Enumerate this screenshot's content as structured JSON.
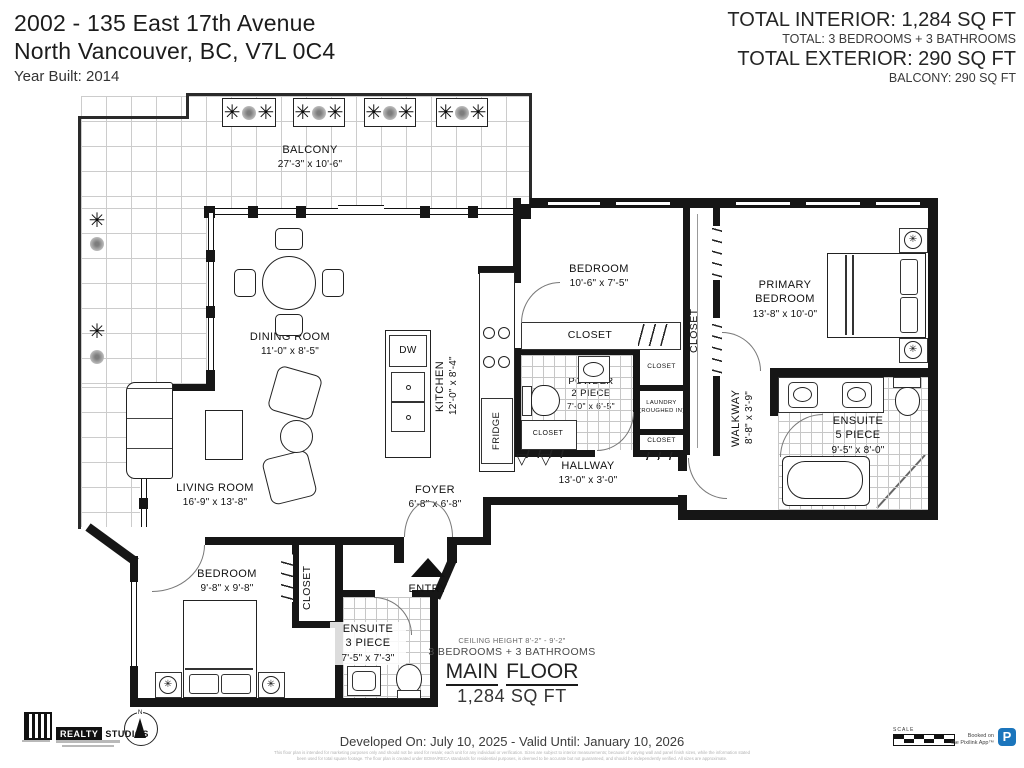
{
  "header": {
    "address_line1": "2002 - 135 East 17th Avenue",
    "address_line2": "North Vancouver, BC, V7L 0C4",
    "year_built": "Year Built: 2014",
    "total_interior": "TOTAL INTERIOR: 1,284 SQ FT",
    "total_interior_sub": "TOTAL: 3 BEDROOMS + 3 BATHROOMS",
    "total_exterior": "TOTAL EXTERIOR: 290 SQ FT",
    "total_exterior_sub": "BALCONY: 290 SQ FT"
  },
  "rooms": {
    "balcony": {
      "name": "BALCONY",
      "dims": "27'-3\" x 10'-6\""
    },
    "dining": {
      "name": "DINING ROOM",
      "dims": "11'-0\" x 8'-5\""
    },
    "living": {
      "name": "LIVING ROOM",
      "dims": "16'-9\" x 13'-8\""
    },
    "kitchen": {
      "name": "KITCHEN",
      "dims": "12'-0\" x 8'-4\""
    },
    "bedroom2": {
      "name": "BEDROOM",
      "dims": "10'-6\" x 7'-5\""
    },
    "primary": {
      "line1": "PRIMARY",
      "line2": "BEDROOM",
      "dims": "13'-8\" x 10'-0\""
    },
    "powder": {
      "line1": "POWDER",
      "line2": "2 PIECE",
      "dims": "7'-0\" x 6'-5\""
    },
    "walkway": {
      "name": "WALKWAY",
      "dims": "8'-8\" x 3'-9\""
    },
    "ensuite5": {
      "line1": "ENSUITE",
      "line2": "5 PIECE",
      "dims": "9'-5\" x 8'-0\""
    },
    "hallway": {
      "name": "HALLWAY",
      "dims": "13'-0\" x 3'-0\""
    },
    "foyer": {
      "name": "FOYER",
      "dims": "6'-8\" x 6'-8\""
    },
    "bedroom3": {
      "name": "BEDROOM",
      "dims": "9'-8\" x 9'-8\""
    },
    "ensuite3": {
      "line1": "ENSUITE",
      "line2": "3 PIECE",
      "dims": "7'-5\" x 7'-3\""
    },
    "closet": "CLOSET",
    "laundry_line1": "LAUNDRY",
    "laundry_line2": "(ROUGHED IN)",
    "entry": "ENTRY",
    "appliances": {
      "dw": "DW",
      "fridge": "FRIDGE"
    }
  },
  "summary": {
    "ceiling": "CEILING HEIGHT 8'-2\" - 9'-2\"",
    "beds_baths": "3 BEDROOMS + 3 BATHROOMS",
    "floor_word1": "MAIN",
    "floor_word2": "FLOOR",
    "floor_area": "1,284 SQ FT"
  },
  "footer": {
    "brand_primary": "REALTY",
    "brand_secondary": "STUDIOS",
    "developed": "Developed On: July 10, 2025 - Valid Until: January 10, 2026",
    "scale_label": "SCALE",
    "booked_line1": "Booked on",
    "booked_line2": "the Pixilink App™",
    "pixilink_p": "P",
    "compass_n": "N",
    "disclaimer_line1": "This floor plan is intended for marketing purposes only and should not be used for resale; each unit for any individual or verification. Sizes are subject to interior measurements; because of varying wall and panel finish sizes, while the information stated",
    "disclaimer_line2": "been used for total square footage. The floor plan is created under BOMA/RECA standards for residential purposes, is deemed to be accurate but not guaranteed, and should be independently verified. All sizes are approximate."
  },
  "icons": {
    "plant": "✳",
    "fan": "✳",
    "door_leaf": "▽"
  },
  "colors": {
    "wall": "#161616",
    "pixilink_blue": "#1b75bc"
  }
}
